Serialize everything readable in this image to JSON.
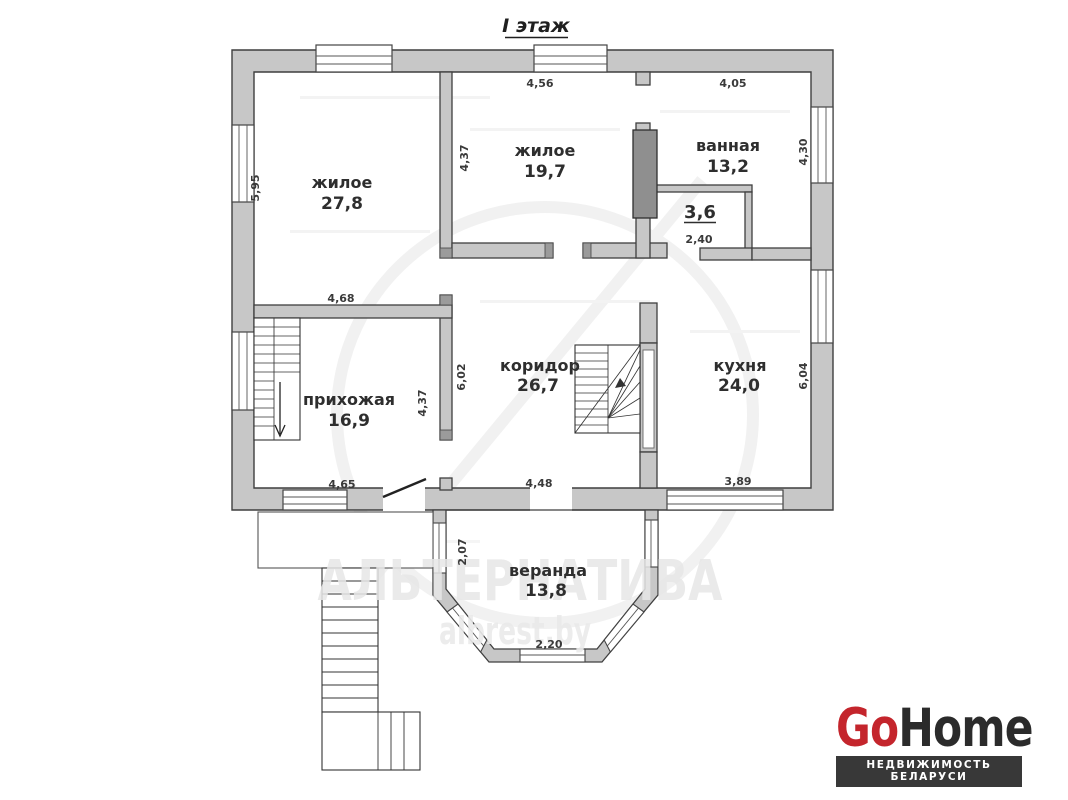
{
  "page": {
    "title": "I этаж"
  },
  "floor_plan": {
    "rooms": [
      {
        "id": "living1",
        "name": "жилое",
        "area": "27,8"
      },
      {
        "id": "living2",
        "name": "жилое",
        "area": "19,7"
      },
      {
        "id": "bathroom",
        "name": "ванная",
        "area": "13,2"
      },
      {
        "id": "small-room",
        "name": "",
        "area": "3,6"
      },
      {
        "id": "corridor",
        "name": "коридор",
        "area": "26,7"
      },
      {
        "id": "hallway",
        "name": "прихожая",
        "area": "16,9"
      },
      {
        "id": "kitchen",
        "name": "кухня",
        "area": "24,0"
      },
      {
        "id": "veranda",
        "name": "веранда",
        "area": "13,8"
      }
    ],
    "dimensions": {
      "living1_width": "4,68",
      "living1_height": "5,95",
      "living2_width": "4,56",
      "living2_height": "4,37",
      "bathroom_width": "4,05",
      "bathroom_height": "4,30",
      "small_room_width": "2,40",
      "corridor_width": "4,48",
      "corridor_height": "6,02",
      "hallway_width": "4,65",
      "hallway_height": "4,37",
      "kitchen_width": "3,89",
      "kitchen_height": "6,04",
      "veranda_height": "2,07",
      "veranda_bay_width": "2,20"
    }
  },
  "watermark": {
    "line1": "АЛЬТЕРНАТИВА",
    "line2": "albrest.by"
  },
  "logo": {
    "brand_part1": "Go",
    "brand_part2": "Home",
    "tagline": "НЕДВИЖИМОСТЬ БЕЛАРУСИ",
    "accent_color": "#c4252c",
    "text_color": "#2b2b2b",
    "bar_color": "#383838",
    "bar_text_color": "#ffffff"
  }
}
